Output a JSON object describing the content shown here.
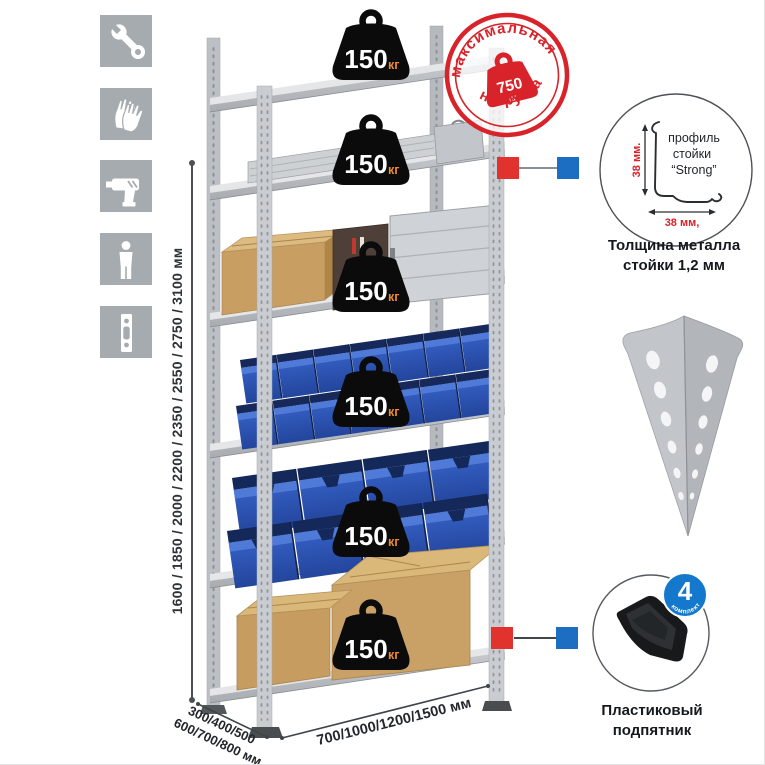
{
  "left_icons": {
    "items": [
      {
        "name": "wrench-icon"
      },
      {
        "name": "gloves-icon"
      },
      {
        "name": "drill-icon"
      },
      {
        "name": "person-icon"
      },
      {
        "name": "perforated-strip-icon"
      }
    ]
  },
  "height_dimension": {
    "label": "1600 / 1850 / 2000 / 2200 / 2350 / 2550 / 2750 / 3100 мм"
  },
  "rack": {
    "shelves": 6,
    "load_value": "150",
    "load_unit": "кг"
  },
  "max_load_stamp": {
    "arc_top": "максимальная",
    "arc_bottom": "нагрузка",
    "value": "750",
    "unit": "кг"
  },
  "profile_detail": {
    "line1": "профиль",
    "line2": "стойки",
    "line3": "“Strong”",
    "dim_v": "38 мм.",
    "dim_h": "38 мм,",
    "caption1": "Толщина металла",
    "caption2": "стойки 1,2 мм"
  },
  "foot_detail": {
    "badge_number": "4",
    "badge_label": "в комплекте",
    "caption1": "Пластиковый",
    "caption2": "подпятник"
  },
  "base_dimensions": {
    "depth_line1": "300/400/500",
    "depth_line2": "600/700/800 мм",
    "width": "700/1000/1200/1500 мм"
  },
  "colors": {
    "stamp_red": "#d8232a",
    "marker_red": "#e2322e",
    "marker_blue": "#1b6ec2",
    "bin_blue": "#2e5cc4",
    "icon_gray": "#a6abaf"
  }
}
